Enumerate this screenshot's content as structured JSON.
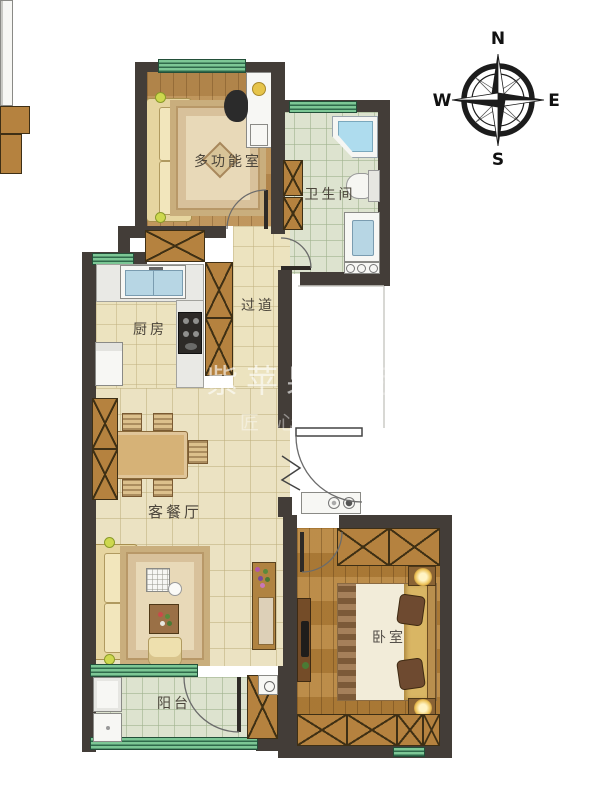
{
  "compass": {
    "north": "N",
    "south": "S",
    "east": "E",
    "west": "W"
  },
  "rooms": {
    "multi_function": "多功能室",
    "bathroom": "卫生间",
    "hallway": "过道",
    "kitchen": "厨房",
    "living_dining": "客餐厅",
    "bedroom": "卧室",
    "balcony": "阳台"
  },
  "watermark": {
    "brand_strong": "紫苹果",
    "brand_faint": "国际设计",
    "slogan": "匠心"
  },
  "colors": {
    "wall": "#433d38",
    "window_green": "#7cc795",
    "wood": "#b98c4f",
    "cabinet": "#b5823f",
    "tile_cream": "#ebe2c2",
    "tile_green": "#dde3cf",
    "fixture_blue": "#b7d6e4"
  }
}
